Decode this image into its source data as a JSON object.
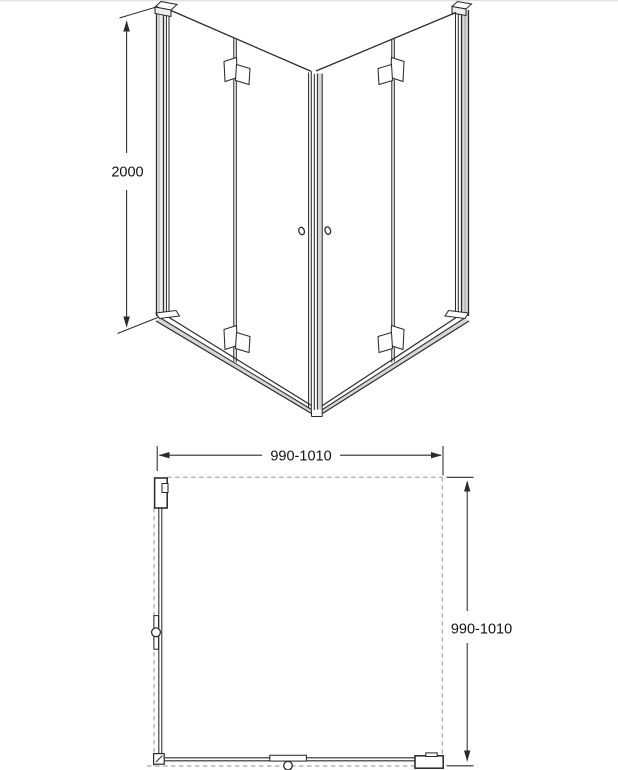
{
  "drawing": {
    "views": {
      "front": {
        "height_dim": "2000"
      },
      "plan": {
        "width_dim": "990-1010",
        "depth_dim": "990-1010"
      }
    },
    "colors": {
      "line": "#2b2b2b",
      "line_soft": "#9a9a9a",
      "dashed": "#b4b4b4",
      "fill_light": "#ededed",
      "fill_mid": "#d7d7d7",
      "text": "#111111",
      "background": "#ffffff"
    }
  }
}
